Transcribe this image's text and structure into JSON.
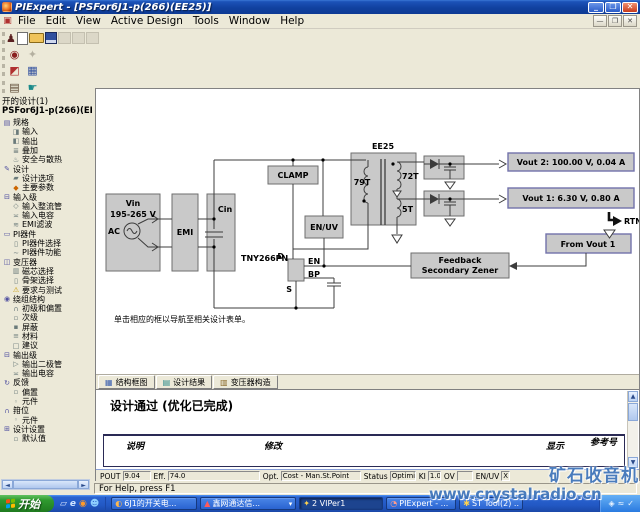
{
  "window": {
    "title": "PIExpert - [PSFor6J1-p(266)(EE25)]",
    "menu": [
      "File",
      "Edit",
      "View",
      "Active Design",
      "Tools",
      "Window",
      "Help"
    ]
  },
  "toolbar": {
    "row1": [
      {
        "icon": "pi-wizard-icon"
      },
      {
        "icon": "new-file-icon"
      },
      {
        "icon": "open-file-icon"
      },
      {
        "icon": "save-file-icon"
      },
      {
        "icon": "disabled-tool-icon-1"
      },
      {
        "icon": "disabled-tool-icon-2"
      },
      {
        "icon": "disabled-tool-icon-3"
      }
    ],
    "row2": [
      {
        "icon": "optimize-target-icon"
      },
      {
        "icon": "toolbox-disabled-icon"
      }
    ],
    "row3": [
      {
        "icon": "design-wizard-icon"
      },
      {
        "icon": "datasheet-icon"
      }
    ],
    "row4": [
      {
        "icon": "report-icon"
      },
      {
        "icon": "pan-hand-icon"
      }
    ]
  },
  "sidebar": {
    "header": "开的设计(1)",
    "design_name": "PSFor6J1-p(266)(EE2",
    "items": [
      {
        "label": "规格",
        "level": 0,
        "ic": "▤",
        "c": "b"
      },
      {
        "label": "输入",
        "level": 1,
        "ic": "◨",
        "c": "g"
      },
      {
        "label": "输出",
        "level": 1,
        "ic": "◧",
        "c": "g"
      },
      {
        "label": "叠加",
        "level": 1,
        "ic": "≣",
        "c": "g"
      },
      {
        "label": "安全与散热",
        "level": 1,
        "ic": "♨",
        "c": "g"
      },
      {
        "label": "设计",
        "level": 0,
        "ic": "✎",
        "c": "b"
      },
      {
        "label": "设计选项",
        "level": 1,
        "ic": "▰",
        "c": "g"
      },
      {
        "label": "主要参数",
        "level": 1,
        "ic": "◆",
        "c": "o"
      },
      {
        "label": "输入级",
        "level": 0,
        "ic": "⊟",
        "c": "b"
      },
      {
        "label": "输入整流管",
        "level": 1,
        "ic": "◇",
        "c": "g"
      },
      {
        "label": "输入电容",
        "level": 1,
        "ic": "≍",
        "c": "g"
      },
      {
        "label": "EMI滤波",
        "level": 1,
        "ic": "≋",
        "c": "g"
      },
      {
        "label": "PI器件",
        "level": 0,
        "ic": "▭",
        "c": "b"
      },
      {
        "label": "PI器件选择",
        "level": 1,
        "ic": "▯",
        "c": "g"
      },
      {
        "label": "PI器件功能",
        "level": 1,
        "ic": "∼",
        "c": "g"
      },
      {
        "label": "变压器",
        "level": 0,
        "ic": "◫",
        "c": "b"
      },
      {
        "label": "磁芯选择",
        "level": 1,
        "ic": "▥",
        "c": "g"
      },
      {
        "label": "骨架选择",
        "level": 1,
        "ic": "▯",
        "c": "g"
      },
      {
        "label": "要求与测试",
        "level": 1,
        "ic": "⚠",
        "c": "y"
      },
      {
        "label": "绕组结构",
        "level": 0,
        "ic": "◉",
        "c": "b"
      },
      {
        "label": "初级和偏置",
        "level": 1,
        "ic": "∩",
        "c": "g"
      },
      {
        "label": "次级",
        "level": 1,
        "ic": "▫",
        "c": "g"
      },
      {
        "label": "屏蔽",
        "level": 1,
        "ic": "▪",
        "c": "g"
      },
      {
        "label": "材料",
        "level": 1,
        "ic": "≡",
        "c": "g"
      },
      {
        "label": "建议",
        "level": 1,
        "ic": "□",
        "c": "g"
      },
      {
        "label": "输出级",
        "level": 0,
        "ic": "⊟",
        "c": "b"
      },
      {
        "label": "输出二极管",
        "level": 1,
        "ic": "▷",
        "c": "g"
      },
      {
        "label": "输出电容",
        "level": 1,
        "ic": "≍",
        "c": "g"
      },
      {
        "label": "反馈",
        "level": 0,
        "ic": "↻",
        "c": "b"
      },
      {
        "label": "偏置",
        "level": 1,
        "ic": "▫",
        "c": "g"
      },
      {
        "label": "元件",
        "level": 1,
        "ic": "◦",
        "c": "g"
      },
      {
        "label": "箝位",
        "level": 0,
        "ic": "∩",
        "c": "b"
      },
      {
        "label": "元件",
        "level": 1,
        "ic": "◦",
        "c": "g"
      },
      {
        "label": "设计设置",
        "level": 0,
        "ic": "⊞",
        "c": "b"
      },
      {
        "label": "默认值",
        "level": 1,
        "ic": "▫",
        "c": "g"
      }
    ]
  },
  "diagram": {
    "note": "单击相应的框以导航至相关设计表单。",
    "vin_title": "Vin",
    "vin_range": "195-265 V",
    "ac_label": "AC",
    "emi": "EMI",
    "cin": "Cin",
    "clamp": "CLAMP",
    "enuv": "EN/UV",
    "device": "TNY266PN",
    "pin_d": "D",
    "pin_en": "EN",
    "pin_bp": "BP",
    "pin_s": "S",
    "core": "EE25",
    "primary_turns": "79T",
    "sec1_turns": "72T",
    "sec2_turns": "5T",
    "vout2": "Vout 2: 100.00 V, 0.04 A",
    "vout1": "Vout 1: 6.30 V, 0.80 A",
    "rtn": "RTN",
    "from_vout1": "From Vout 1",
    "feedback1": "Feedback",
    "feedback2": "Secondary Zener"
  },
  "tabs": [
    {
      "label": "结构框图",
      "icon": "block-diagram-tab-icon"
    },
    {
      "label": "设计结果",
      "icon": "design-results-tab-icon"
    },
    {
      "label": "变压器构造",
      "icon": "transformer-construction-tab-icon"
    }
  ],
  "results": {
    "heading": "设计通过 (优化已完成)",
    "columns": {
      "c1": "说明",
      "c2": "修改",
      "c3": "显示",
      "c4": "参考号"
    }
  },
  "design_status": {
    "fields": [
      {
        "label": "POUT",
        "value": "9.04"
      },
      {
        "label": "Eff.",
        "value": "74.0"
      },
      {
        "label": "Opt.",
        "value": "Cost - Man.St.Point"
      },
      {
        "label": "Status",
        "value": "Optimization done"
      },
      {
        "label": "KI",
        "value": "1.00"
      },
      {
        "label": "OV",
        "value": ""
      },
      {
        "label": "EN/UV",
        "value": "X"
      }
    ]
  },
  "statusbar": {
    "help_text": "For Help, press F1"
  },
  "taskbar": {
    "start_label": "开始",
    "quick_launch": [
      {
        "icon": "show-desktop-icon"
      },
      {
        "icon": "internet-explorer-icon"
      },
      {
        "icon": "media-player-icon"
      },
      {
        "icon": "messenger-icon"
      }
    ],
    "buttons": [
      {
        "label": "6J1的开关电...",
        "icon": "browser-task-icon"
      },
      {
        "label": "鑫网通达信...",
        "icon": "stock-app-icon"
      },
      {
        "label": "2 VIPer1",
        "icon": "viper-app-icon"
      },
      {
        "label": "PIExpert - ...",
        "icon": "piexpert-app-icon"
      },
      {
        "label": "ST Tool(2) ..",
        "icon": "st-tool-icon"
      }
    ],
    "tray_icons": [
      {
        "icon": "volume-icon",
        "g": "◈"
      },
      {
        "icon": "network-icon",
        "g": "≈"
      },
      {
        "icon": "antivirus-icon",
        "g": "✓"
      }
    ]
  },
  "watermark": {
    "line1": "矿石收音机",
    "line2": "www.crystalradio.cn"
  }
}
